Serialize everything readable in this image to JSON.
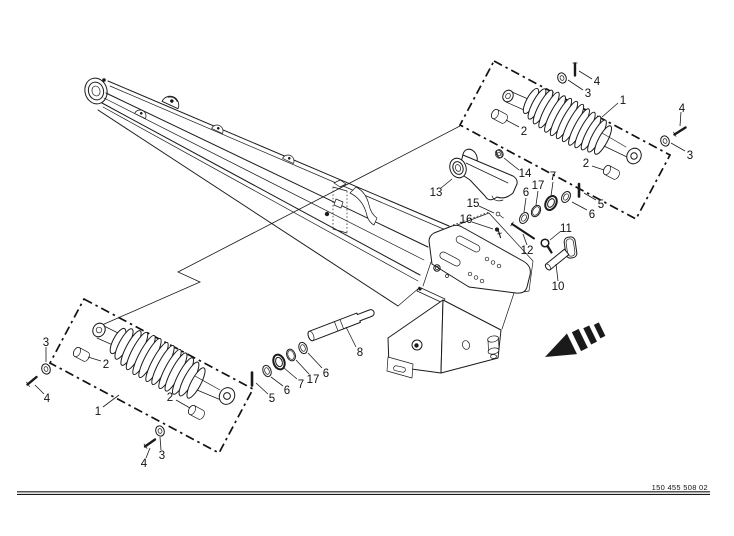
{
  "diagram": {
    "type": "exploded-parts-diagram",
    "subject": "tension spring assemblies on implement drawbar frame",
    "doc_number": "150 455 508 02",
    "colors": {
      "ink": "#1a1a1a",
      "background": "#ffffff",
      "arrow_fill": "#000000"
    },
    "icons": {
      "direction_arrow": "solid black arrow with dashed tail pointing lower-left"
    },
    "callouts": [
      "4",
      "3",
      "1",
      "4",
      "3",
      "2",
      "2",
      "5",
      "6",
      "7",
      "17",
      "6",
      "14",
      "13",
      "15",
      "16",
      "12",
      "11",
      "10",
      "3",
      "4",
      "2",
      "1",
      "2",
      "3",
      "4",
      "5",
      "6",
      "7",
      "17",
      "6",
      "8"
    ]
  }
}
